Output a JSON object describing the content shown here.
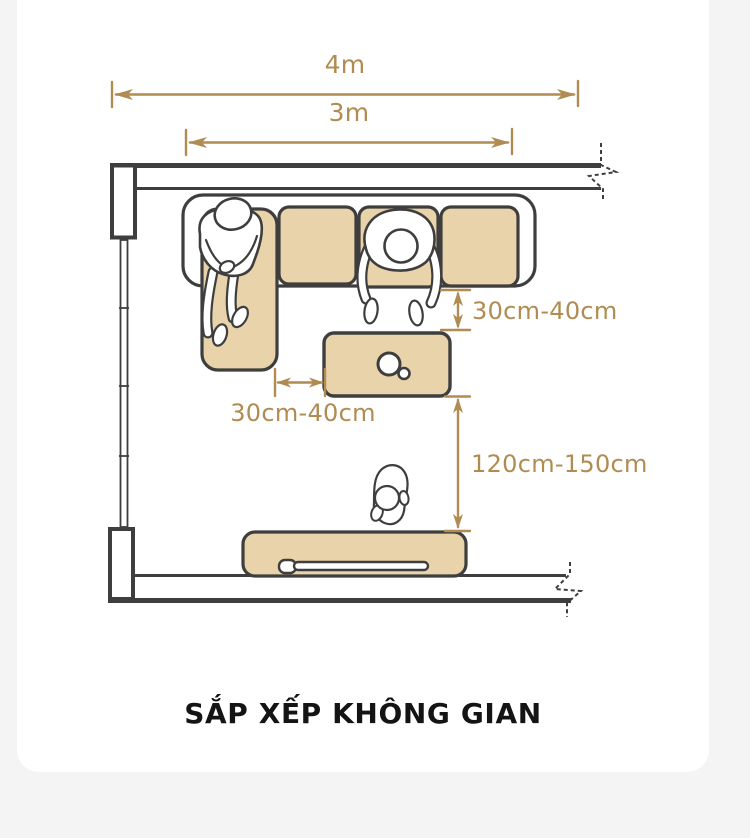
{
  "page": {
    "background_color": "#f4f4f4",
    "card_color": "#ffffff"
  },
  "title": {
    "text": "SẮP XẾP KHÔNG GIAN"
  },
  "dims": {
    "overall": {
      "label": "4m"
    },
    "sofa": {
      "label": "3m"
    },
    "sofa_to_table": {
      "label": "30cm-40cm"
    },
    "chaise_to_table": {
      "label": "30cm-40cm"
    },
    "table_to_tv": {
      "label": "120cm-150cm"
    }
  },
  "colors": {
    "outline": "#3e3e3e",
    "furniture_fill": "#e9d3ab",
    "dimension": "#b08c52",
    "title_text": "#141414"
  },
  "scene": {
    "icons": [
      "l-shaped-sofa-icon",
      "chaise-cushion-icon",
      "seat-cushion-icon",
      "coffee-table-icon",
      "cup-icon",
      "tv-stand-icon",
      "tv-icon",
      "person-on-chaise-icon",
      "person-leaning-icon",
      "person-by-tv-icon",
      "window-icon",
      "wall-break-icon"
    ]
  }
}
